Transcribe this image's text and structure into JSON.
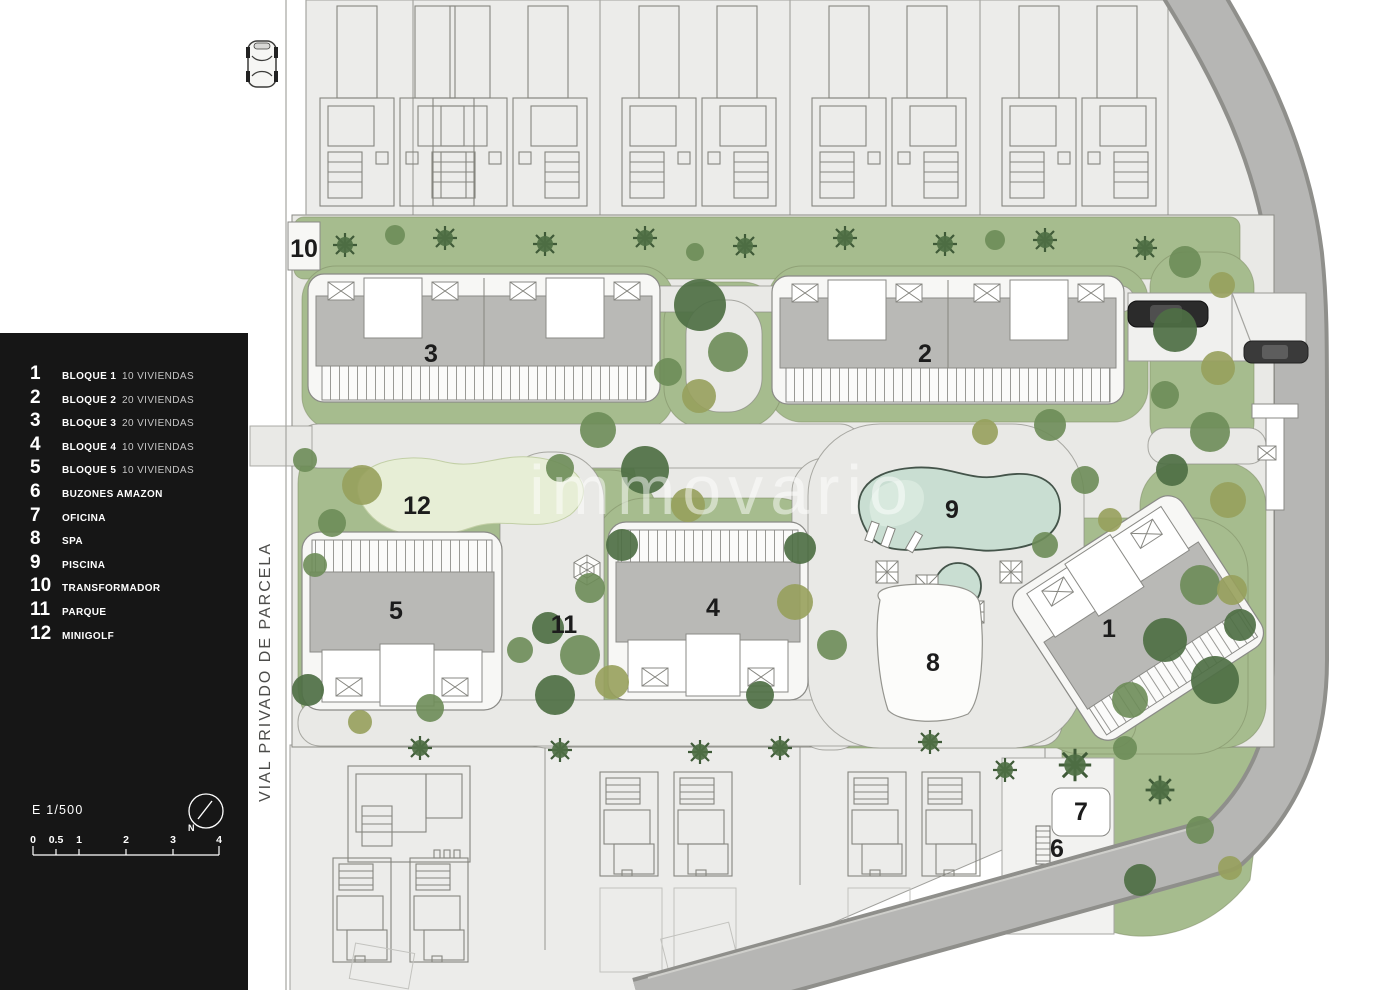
{
  "legend": {
    "items": [
      {
        "num": "1",
        "label": "BLOQUE 1",
        "detail": "10 VIVIENDAS"
      },
      {
        "num": "2",
        "label": "BLOQUE 2",
        "detail": "20 VIVIENDAS"
      },
      {
        "num": "3",
        "label": "BLOQUE 3",
        "detail": "20 VIVIENDAS"
      },
      {
        "num": "4",
        "label": "BLOQUE 4",
        "detail": "10 VIVIENDAS"
      },
      {
        "num": "5",
        "label": "BLOQUE 5",
        "detail": "10 VIVIENDAS"
      },
      {
        "num": "6",
        "label": "BUZONES AMAZON",
        "detail": ""
      },
      {
        "num": "7",
        "label": "OFICINA",
        "detail": ""
      },
      {
        "num": "8",
        "label": "SPA",
        "detail": ""
      },
      {
        "num": "9",
        "label": "PISCINA",
        "detail": ""
      },
      {
        "num": "10",
        "label": "TRANSFORMADOR",
        "detail": ""
      },
      {
        "num": "11",
        "label": "PARQUE",
        "detail": ""
      },
      {
        "num": "12",
        "label": "MINIGOLF",
        "detail": ""
      }
    ],
    "scale": {
      "label": "E 1/500",
      "north_label": "N",
      "ticks": [
        "0",
        "0.5",
        "1",
        "2",
        "3",
        "4"
      ]
    }
  },
  "plan": {
    "road_label": "VIAL PRIVADO DE PARCELA",
    "watermark": "immovario",
    "markers": {
      "block1": "1",
      "block2": "2",
      "block3": "3",
      "block4": "4",
      "block5": "5",
      "buzones": "6",
      "oficina": "7",
      "spa": "8",
      "piscina": "9",
      "transformador": "10",
      "parque": "11",
      "minigolf": "12"
    }
  },
  "colors": {
    "legend-bg": "#161616",
    "legend-text": "#ffffff",
    "legend-muted": "#c6c6c6",
    "paper": "#ffffff",
    "plot-bg": "#ececea",
    "path-bg": "#e9e9e6",
    "lawn": "#a6bc8e",
    "tree-dark": "#4e6f44",
    "tree-mid": "#6d8c58",
    "tree-olive": "#97a05c",
    "pool": "#c9ded2",
    "pool-edge": "#44544a",
    "building-gray": "#b9b9b6",
    "road": "#b6b6b4",
    "road-edge": "#8f8f8b",
    "minigolf": "#e7eed6",
    "label-ink": "#1c1c1c"
  }
}
